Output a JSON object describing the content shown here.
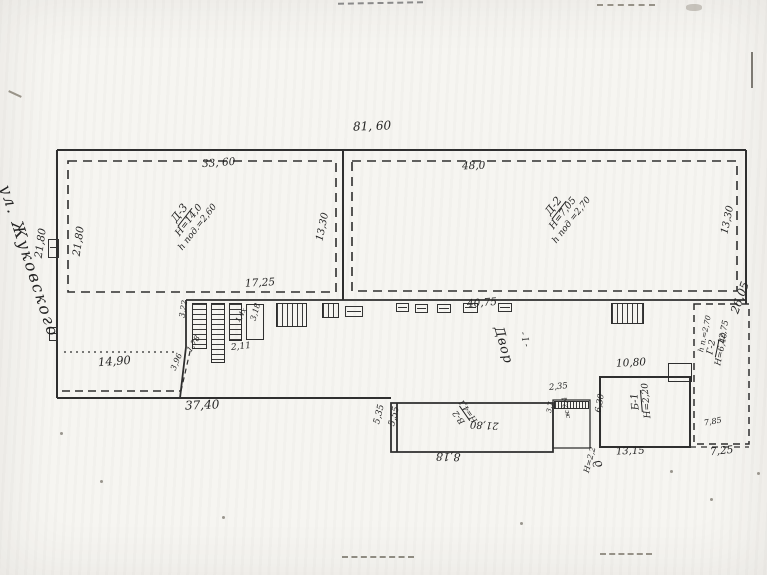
{
  "plan": {
    "street_label": "ул. Жуковского",
    "overall": {
      "top": "81, 60",
      "right": "26,05",
      "bottom_left": "37,40"
    },
    "building_d3": {
      "name": "Д-3",
      "height": "Н=14,0",
      "basement": "h под.=2,60",
      "top_dim": "33, 60",
      "side_dim": "13,30",
      "left_outer_dim": "21,80",
      "left_inner_dim": "21,80"
    },
    "building_d2": {
      "name": "Д-2",
      "height": "Н=7,05",
      "basement": "h под =2,70",
      "top_dim": "48,0",
      "side_dim": "13,30"
    },
    "courtyard": {
      "name": "Двор",
      "index": "- I -",
      "top_dim": "17,25",
      "len_dim": "40,75",
      "small_dims": [
        "3,22",
        "1,78",
        "2,11",
        "3,18",
        "1,4х"
      ]
    },
    "left_yard": {
      "dim": "14,90",
      "diag_dim": "3,96"
    },
    "building_v2": {
      "name": "В-2",
      "height": "Н=4,1",
      "len_dim": "21,80",
      "bottom_dim": "8,18",
      "left_outer_dim": "5,35",
      "left_inner_dim": "5,55"
    },
    "shed": {
      "top_dim": "2,35",
      "label": "ж 2,4",
      "side_dim": "3,7",
      "below_height": "Н=2,2",
      "below_name": "д"
    },
    "building_b1": {
      "name": "Б-1",
      "height": "Н=2,20",
      "top_dim": "10,80",
      "left_dim": "6,30",
      "bottom_dim": "13,15"
    },
    "building_g2": {
      "name": "Г-2",
      "height": "Н=6,40",
      "basement": "h п.=2,70",
      "len_dim": "12,75",
      "width_in": "7,85",
      "width_out": "7,25"
    }
  }
}
